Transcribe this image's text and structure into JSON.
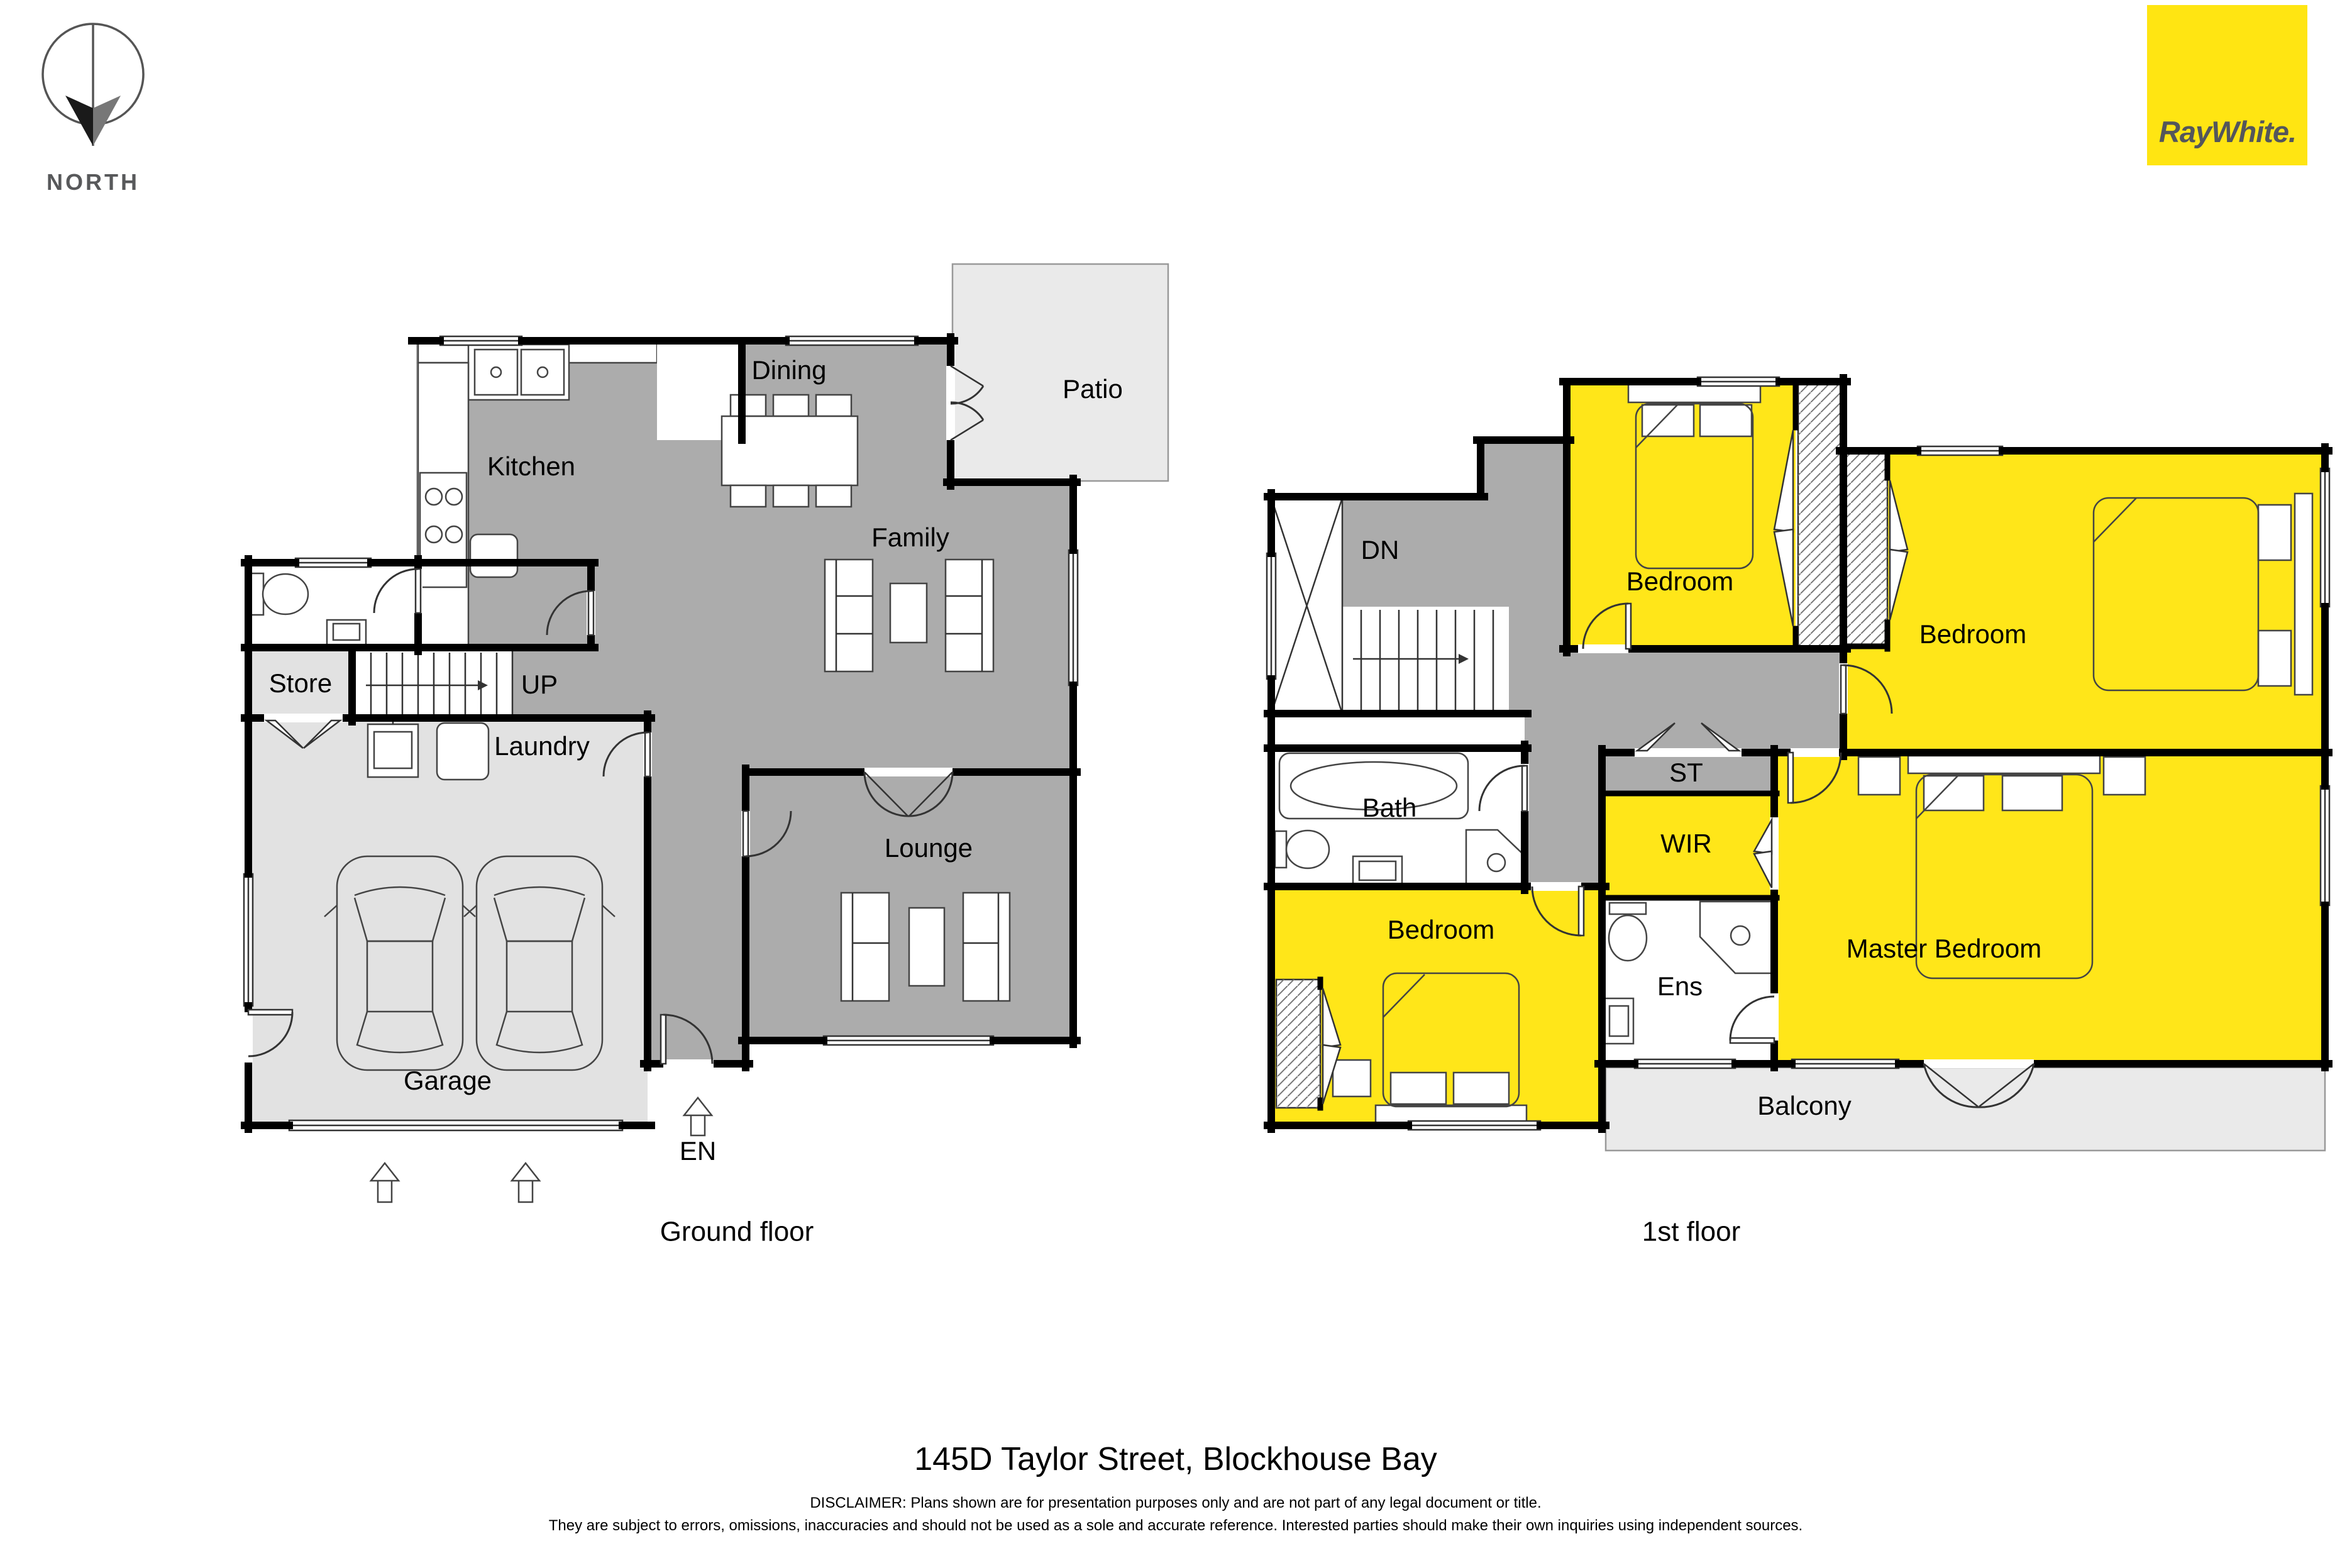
{
  "north": {
    "label": "NORTH"
  },
  "logo": {
    "brand": "RayWhite."
  },
  "ground_floor": {
    "caption": "Ground floor",
    "rooms": {
      "kitchen": "Kitchen",
      "dining": "Dining",
      "patio": "Patio",
      "family": "Family",
      "lounge": "Lounge",
      "store": "Store",
      "stairs_up": "UP",
      "laundry": "Laundry",
      "garage": "Garage",
      "entry": "EN"
    }
  },
  "first_floor": {
    "caption": "1st floor",
    "rooms": {
      "stairs_down": "DN",
      "bedroom_top": "Bedroom",
      "bedroom_right": "Bedroom",
      "bedroom_left": "Bedroom",
      "bath": "Bath",
      "store": "ST",
      "wir": "WIR",
      "ensuite": "Ens",
      "master_bedroom": "Master Bedroom",
      "balcony": "Balcony"
    }
  },
  "footer": {
    "address": "145D Taylor Street, Blockhouse Bay",
    "disclaimer_line1": "DISCLAIMER: Plans shown are for presentation purposes only and are not part of any legal document or title.",
    "disclaimer_line2": "They are subject to errors, omissions, inaccuracies and should not be used as a sole and accurate reference. Interested parties should make their own inquiries using independent sources."
  },
  "colors": {
    "brand_yellow": "#FFE512",
    "room_yellow": "#FFE619",
    "room_gray": "#ACACAC",
    "room_light_gray": "#E2E2E2",
    "outdoor_gray": "#EAEAEA",
    "wall_black": "#000000",
    "logo_text_gray": "#54565B"
  }
}
